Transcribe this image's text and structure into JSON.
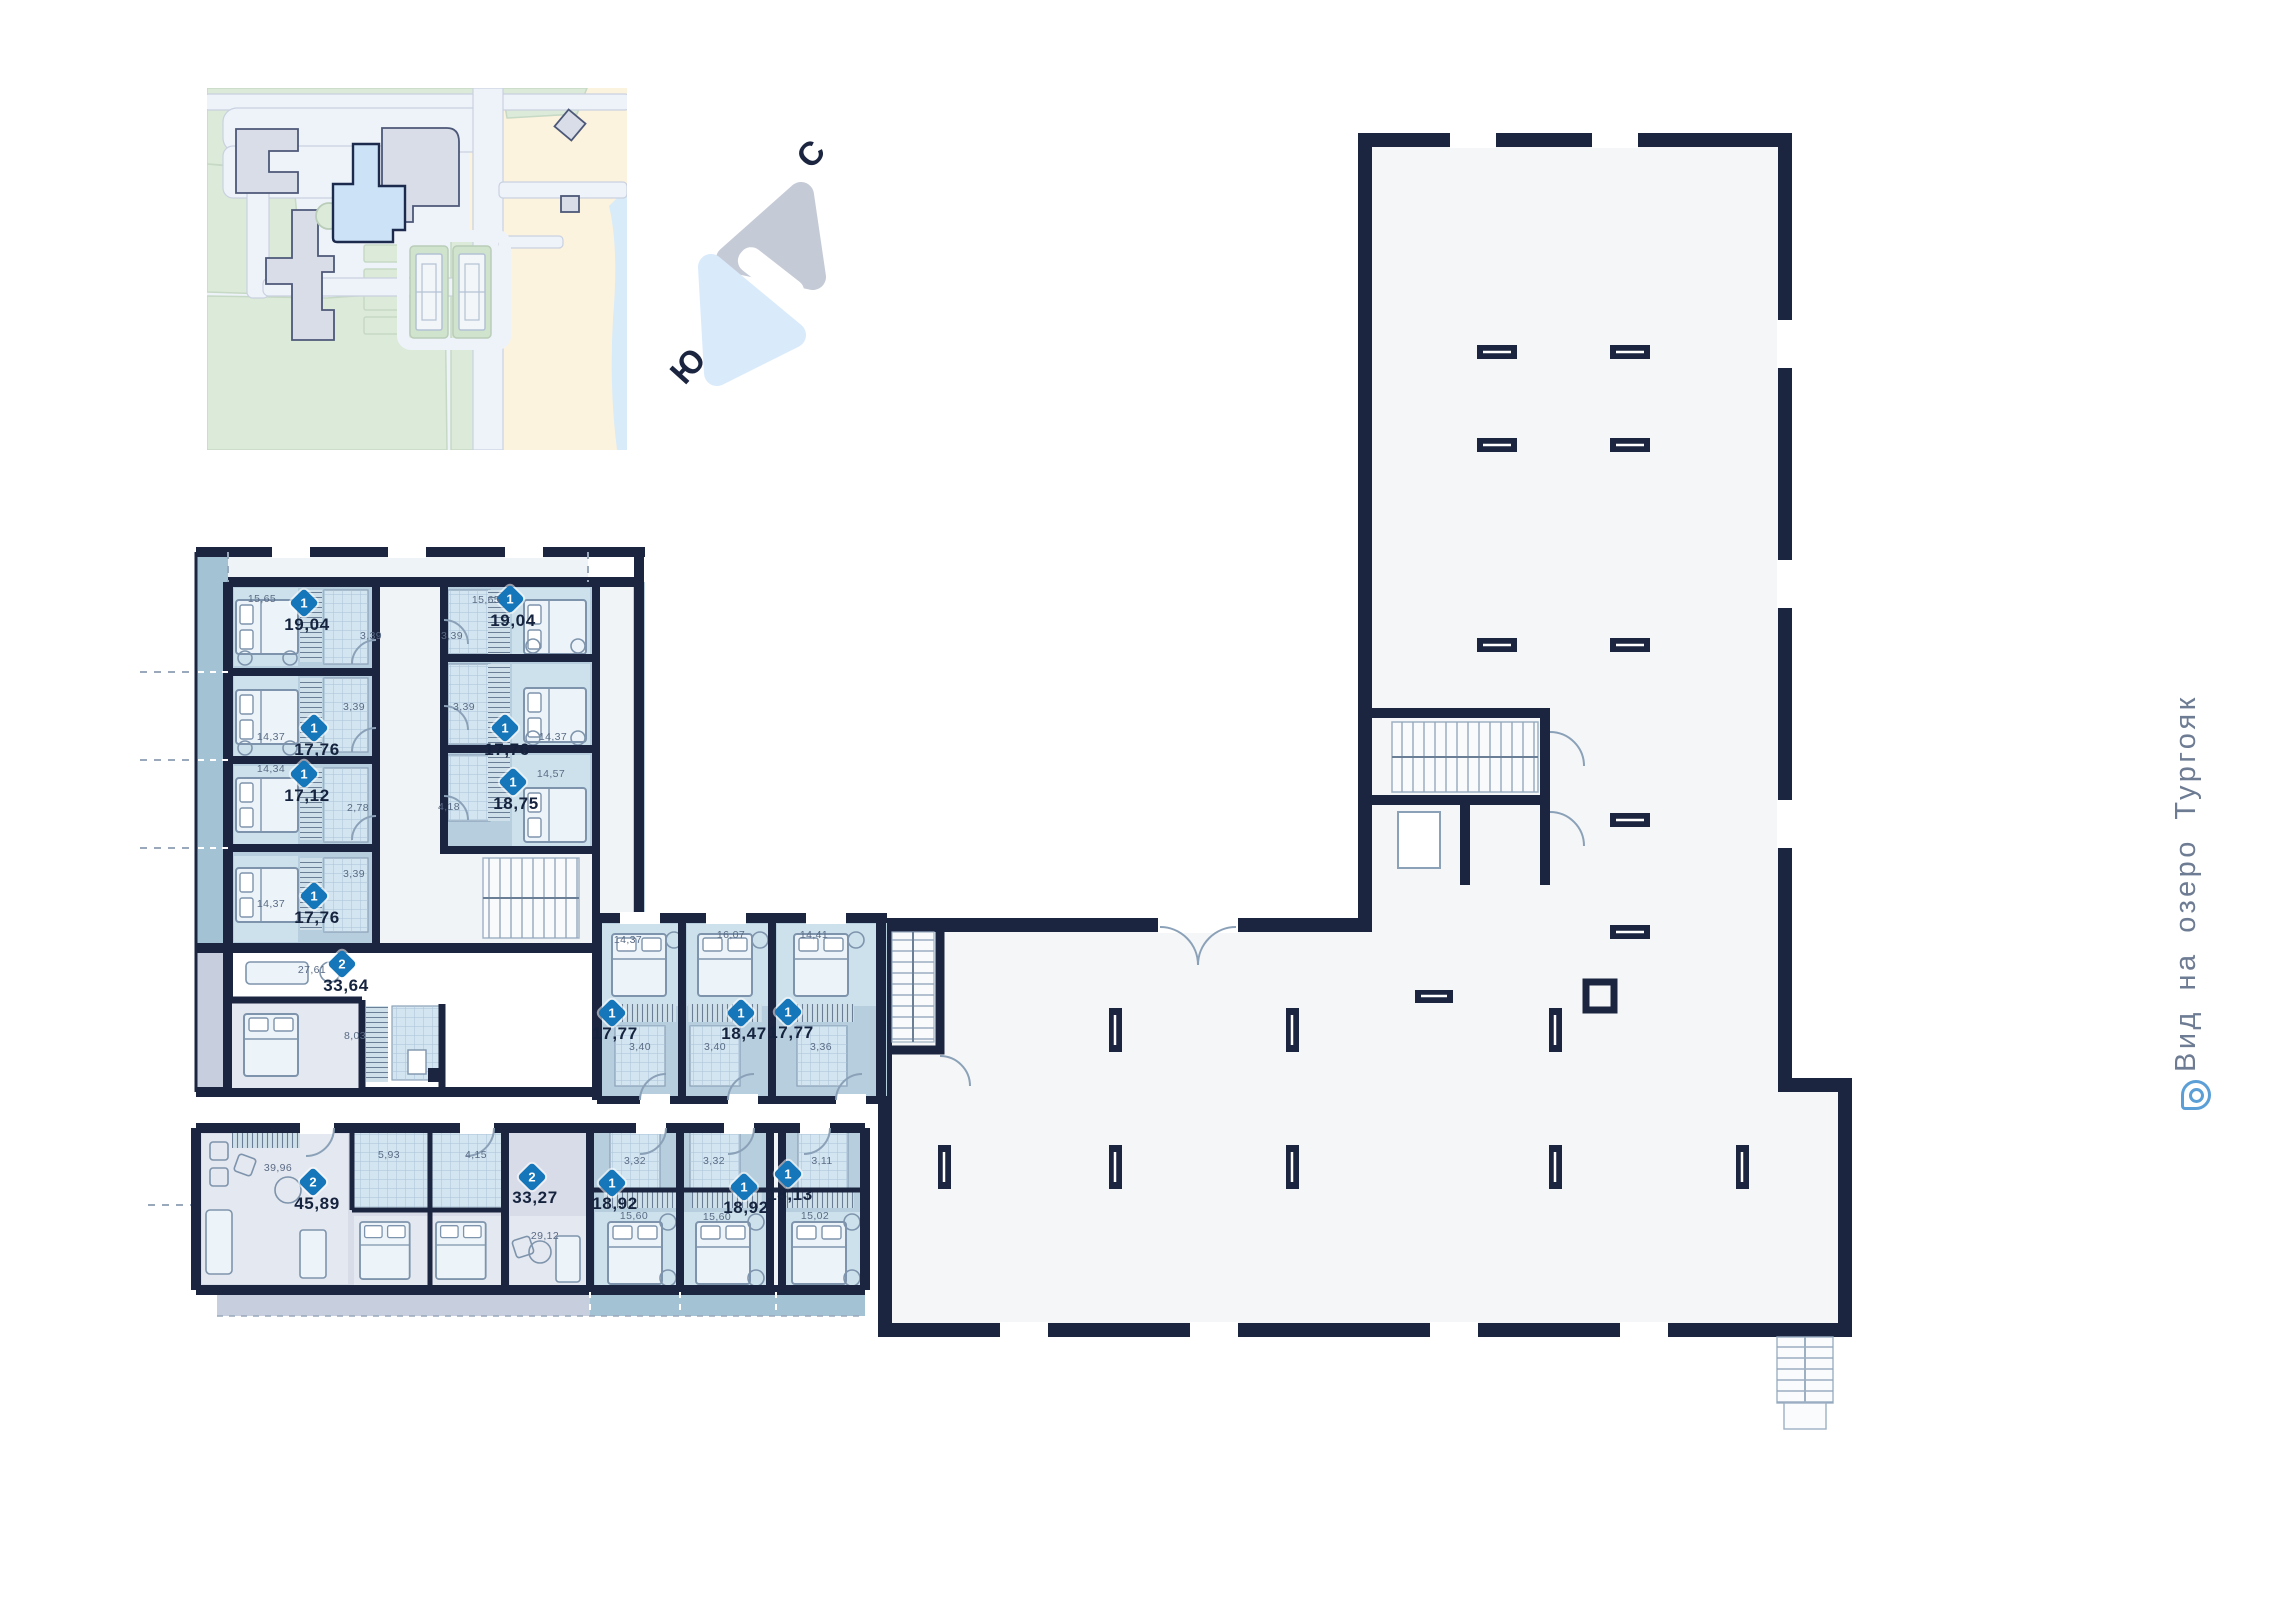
{
  "compass": {
    "north": "С",
    "south": "Ю"
  },
  "side_note": {
    "label": "Вид на озеро Тургояк"
  },
  "palette": {
    "wall": "#1b2540",
    "apartment_blue": "#b6cedd",
    "room_blue": "#cde1ec",
    "bath_tile": "#d3e5f0",
    "apartment_gray": "#d8dce8",
    "room_gray": "#e4e8f0",
    "balcony_blue": "#a3c2d3",
    "balcony_gray": "#c7cedd",
    "common_area": "#f4f6f8",
    "badge_blue": "#1577ba",
    "area_text": "#15233e",
    "room_text": "#5a6b85",
    "accent_icon": "#5b9fd6"
  },
  "floorplan": {
    "units": [
      {
        "badge": "1",
        "area": "19,04",
        "bx": 304,
        "by": 603,
        "ax": 307,
        "ay": 625,
        "rooms": [
          {
            "t": "15,65",
            "x": 262,
            "y": 599
          },
          {
            "t": "3,39",
            "x": 371,
            "y": 636
          }
        ]
      },
      {
        "badge": "1",
        "area": "19,04",
        "bx": 510,
        "by": 599,
        "ax": 513,
        "ay": 621,
        "rooms": [
          {
            "t": "15,65",
            "x": 486,
            "y": 600
          },
          {
            "t": "3,39",
            "x": 452,
            "y": 636
          }
        ]
      },
      {
        "badge": "1",
        "area": "17,76",
        "bx": 314,
        "by": 728,
        "ax": 317,
        "ay": 750,
        "rooms": [
          {
            "t": "14,37",
            "x": 271,
            "y": 737
          },
          {
            "t": "3,39",
            "x": 354,
            "y": 707
          }
        ]
      },
      {
        "badge": "1",
        "area": "17,76",
        "bx": 505,
        "by": 728,
        "ax": 507,
        "ay": 750,
        "rooms": [
          {
            "t": "14,37",
            "x": 553,
            "y": 737
          },
          {
            "t": "3,39",
            "x": 464,
            "y": 707
          }
        ]
      },
      {
        "badge": "1",
        "area": "17,12",
        "bx": 304,
        "by": 774,
        "ax": 307,
        "ay": 796,
        "rooms": [
          {
            "t": "14,34",
            "x": 271,
            "y": 769
          },
          {
            "t": "2,78",
            "x": 358,
            "y": 808
          }
        ]
      },
      {
        "badge": "1",
        "area": "18,75",
        "bx": 513,
        "by": 782,
        "ax": 516,
        "ay": 804,
        "rooms": [
          {
            "t": "14,57",
            "x": 551,
            "y": 774
          },
          {
            "t": "4,18",
            "x": 449,
            "y": 807
          }
        ]
      },
      {
        "badge": "1",
        "area": "17,76",
        "bx": 314,
        "by": 896,
        "ax": 317,
        "ay": 918,
        "rooms": [
          {
            "t": "14,37",
            "x": 271,
            "y": 904
          },
          {
            "t": "3,39",
            "x": 354,
            "y": 874
          }
        ]
      },
      {
        "badge": "2",
        "area": "33,64",
        "bx": 342,
        "by": 964,
        "ax": 346,
        "ay": 986,
        "rooms": [
          {
            "t": "27,61",
            "x": 312,
            "y": 970
          },
          {
            "t": "8,03",
            "x": 355,
            "y": 1036
          }
        ]
      },
      {
        "badge": "2",
        "area": "45,89",
        "bx": 313,
        "by": 1182,
        "ax": 317,
        "ay": 1204,
        "rooms": [
          {
            "t": "39,96",
            "x": 278,
            "y": 1168
          },
          {
            "t": "5,93",
            "x": 389,
            "y": 1155
          }
        ]
      },
      {
        "badge": "2",
        "area": "33,27",
        "bx": 532,
        "by": 1177,
        "ax": 535,
        "ay": 1198,
        "rooms": [
          {
            "t": "4,15",
            "x": 476,
            "y": 1155
          },
          {
            "t": "29,12",
            "x": 545,
            "y": 1236
          }
        ]
      },
      {
        "badge": "1",
        "area": "18,92",
        "bx": 612,
        "by": 1183,
        "ax": 615,
        "ay": 1204,
        "rooms": [
          {
            "t": "3,32",
            "x": 635,
            "y": 1161
          },
          {
            "t": "15,60",
            "x": 634,
            "y": 1216
          }
        ]
      },
      {
        "badge": "1",
        "area": "18,92",
        "bx": 744,
        "by": 1187,
        "ax": 746,
        "ay": 1208,
        "rooms": [
          {
            "t": "3,32",
            "x": 714,
            "y": 1161
          },
          {
            "t": "15,60",
            "x": 717,
            "y": 1217
          }
        ]
      },
      {
        "badge": "1",
        "area": "18,13",
        "bx": 788,
        "by": 1174,
        "ax": 790,
        "ay": 1195,
        "rooms": [
          {
            "t": "3,11",
            "x": 822,
            "y": 1161
          },
          {
            "t": "15,02",
            "x": 815,
            "y": 1216
          }
        ]
      },
      {
        "badge": "1",
        "area": "17,77",
        "bx": 612,
        "by": 1013,
        "ax": 615,
        "ay": 1034,
        "rooms": [
          {
            "t": "14,37",
            "x": 628,
            "y": 940
          },
          {
            "t": "3,40",
            "x": 640,
            "y": 1047
          }
        ]
      },
      {
        "badge": "1",
        "area": "18,47",
        "bx": 741,
        "by": 1013,
        "ax": 744,
        "ay": 1034,
        "rooms": [
          {
            "t": "16,07",
            "x": 731,
            "y": 935
          },
          {
            "t": "3,40",
            "x": 715,
            "y": 1047
          }
        ]
      },
      {
        "badge": "1",
        "area": "17,77",
        "bx": 788,
        "by": 1012,
        "ax": 791,
        "ay": 1033,
        "rooms": [
          {
            "t": "14,41",
            "x": 814,
            "y": 935
          },
          {
            "t": "3,36",
            "x": 821,
            "y": 1047
          }
        ]
      }
    ]
  }
}
